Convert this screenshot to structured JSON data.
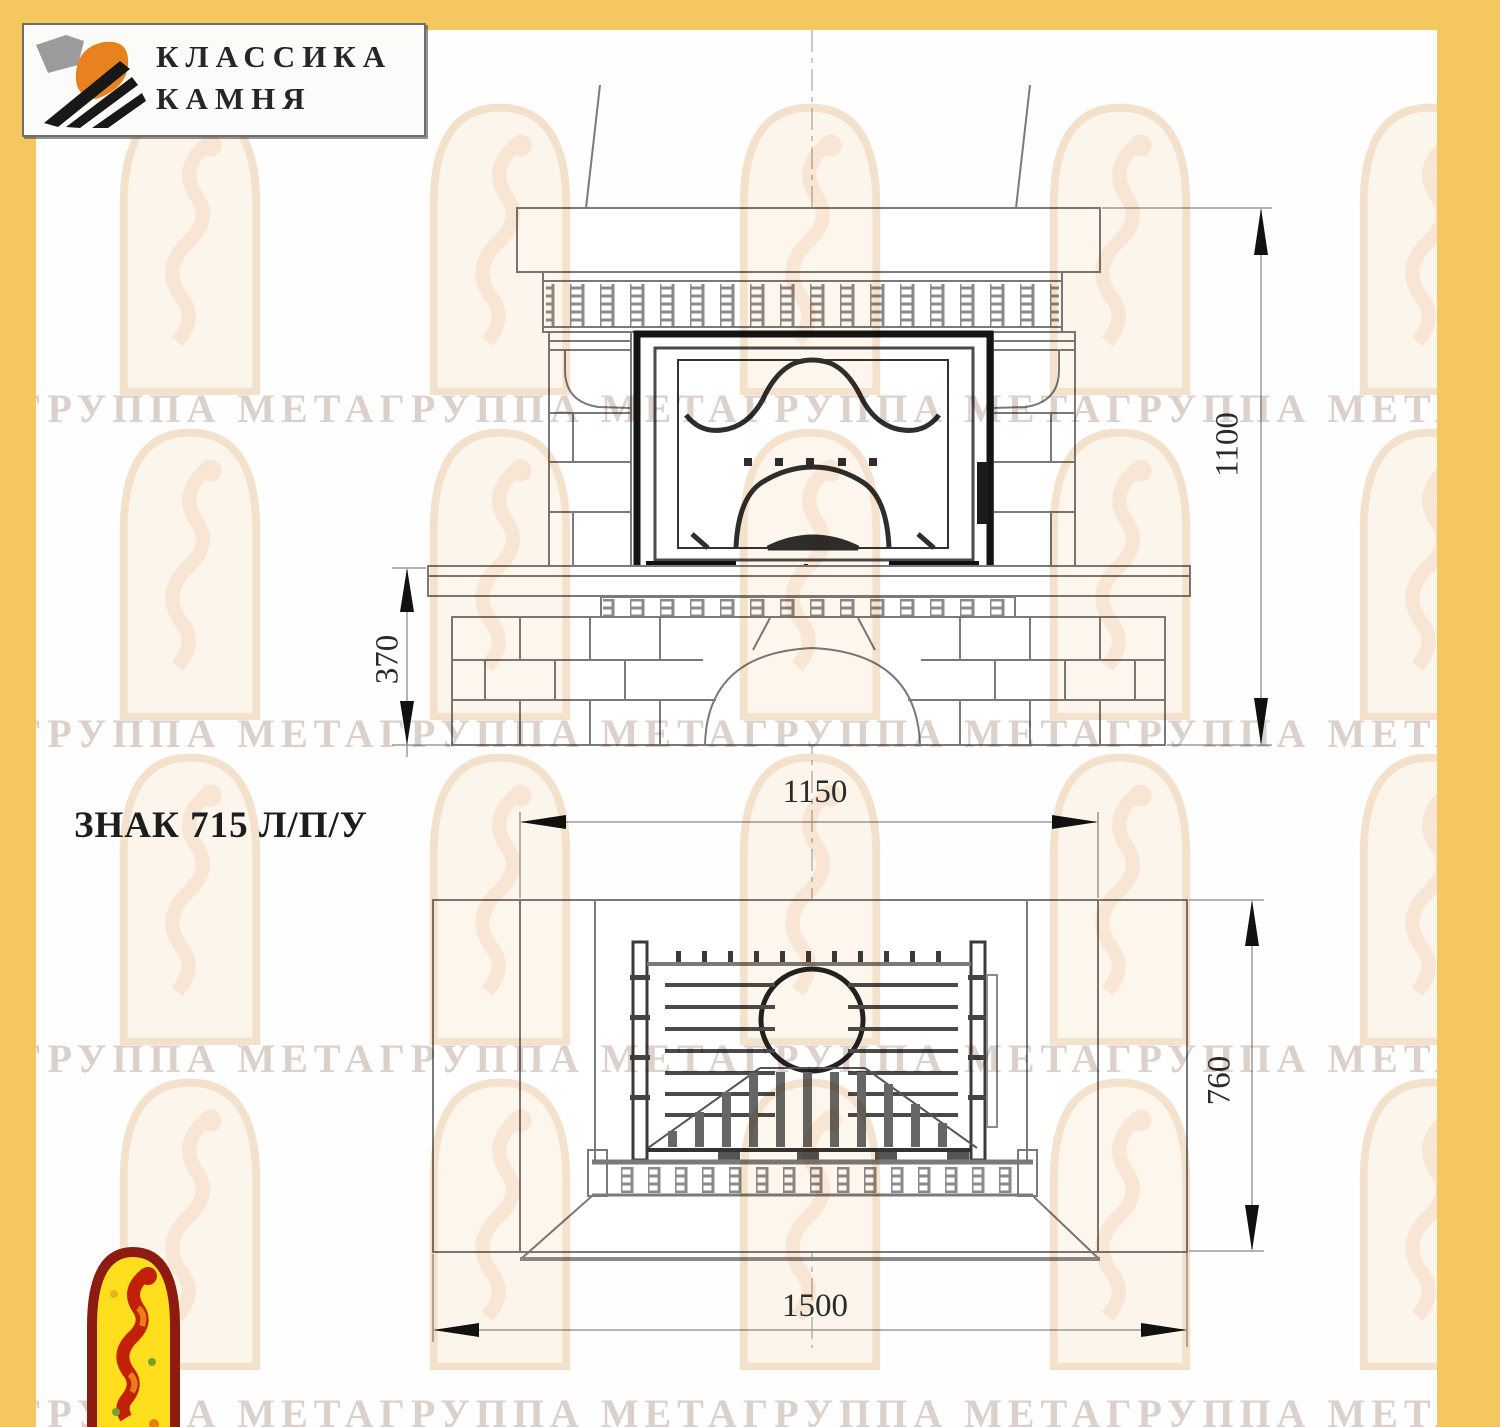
{
  "logo": {
    "line1": "КЛАССИКА",
    "line2": "КАМНЯ"
  },
  "title": {
    "text": "ЗНАК 715 Л/П/У"
  },
  "dimensions": {
    "total_height": "1100",
    "plinth_height": "370",
    "body_width": "1150",
    "depth": "760",
    "total_width": "1500"
  },
  "watermark": {
    "row_text": "ГРУППА МЕТАГРУППА МЕТАГРУППА МЕТАГРУППА МЕТАГРУППА МЕТА"
  },
  "colors": {
    "frame_yellow": "#f5c75f",
    "brand_orange": "#e8821e",
    "badge_red": "#c32009",
    "badge_yellow": "#ffdf1d",
    "line_gray": "#7a7a7a"
  }
}
